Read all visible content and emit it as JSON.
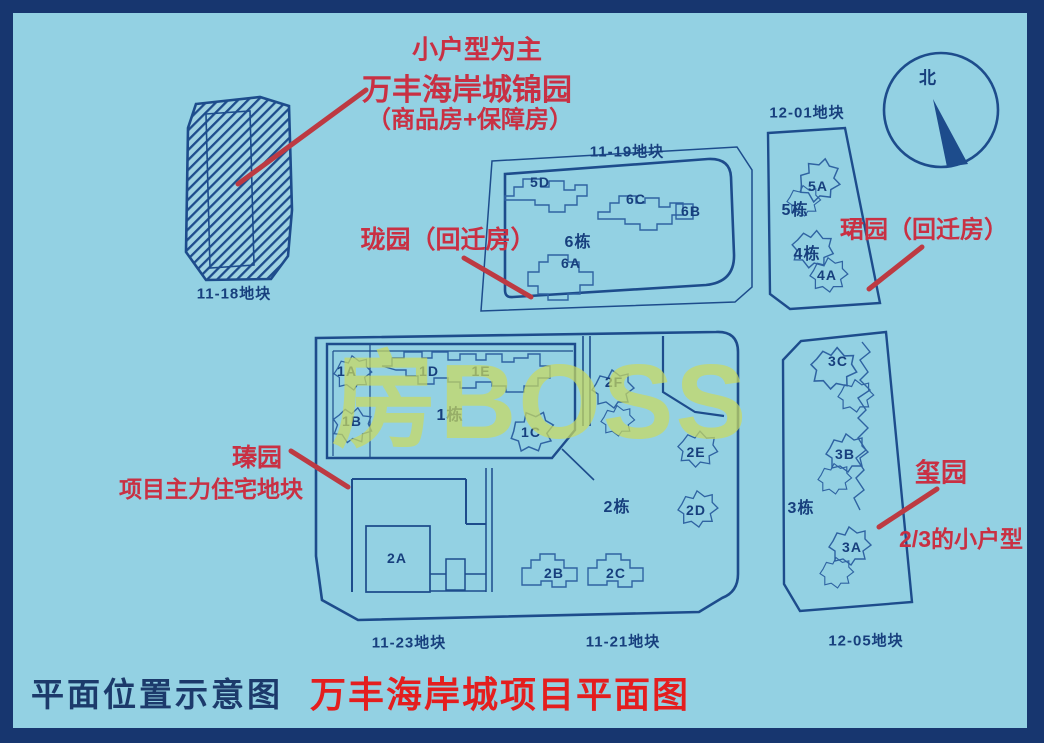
{
  "map": {
    "watermark": "房BOSS",
    "compass_north": "北",
    "plots": {
      "p1118": "11-18地块",
      "p1119": "11-19地块",
      "p1201": "12-01地块",
      "p1123": "11-23地块",
      "p1121": "11-21地块",
      "p1205": "12-05地块"
    },
    "blocks": {
      "b1": "1栋",
      "b2": "2栋",
      "b3": "3栋",
      "b4": "4栋",
      "b5": "5栋",
      "b6": "6栋"
    },
    "units": {
      "u1a": "1A",
      "u1b": "1B",
      "u1c": "1C",
      "u1d": "1D",
      "u1e": "1E",
      "u2a": "2A",
      "u2b": "2B",
      "u2c": "2C",
      "u2d": "2D",
      "u2e": "2E",
      "u2f": "2F",
      "u3a": "3A",
      "u3b": "3B",
      "u3c": "3C",
      "u4a": "4A",
      "u5a": "5A",
      "u5d": "5D",
      "u6a": "6A",
      "u6b": "6B",
      "u6c": "6C"
    }
  },
  "annotations": {
    "top_note": "小户型为主",
    "jinyuan_name": "万丰海岸城锦园",
    "jinyuan_paren": "（商品房+保障房）",
    "longyuan": "珑园（回迁房）",
    "junyuan": "珺园（回迁房）",
    "zhenyuan": "瑧园",
    "zhenyuan_sub": "项目主力住宅地块",
    "xiyuan": "玺园",
    "xiyuan_sub": "2/3的小户型"
  },
  "footer": {
    "caption": "平面位置示意图",
    "title": "万丰海岸城项目平面图"
  },
  "colors": {
    "background": "#93d1e3",
    "frame_navy": "#17366f",
    "plot_line": "#1d4c8c",
    "building_line": "#2f63a2",
    "map_text": "#173f7d",
    "annotation_red": "#c93043",
    "arrow_red": "#bd3a42",
    "title_red": "#e41e1e",
    "watermark_yellow": "#c9d95f"
  }
}
